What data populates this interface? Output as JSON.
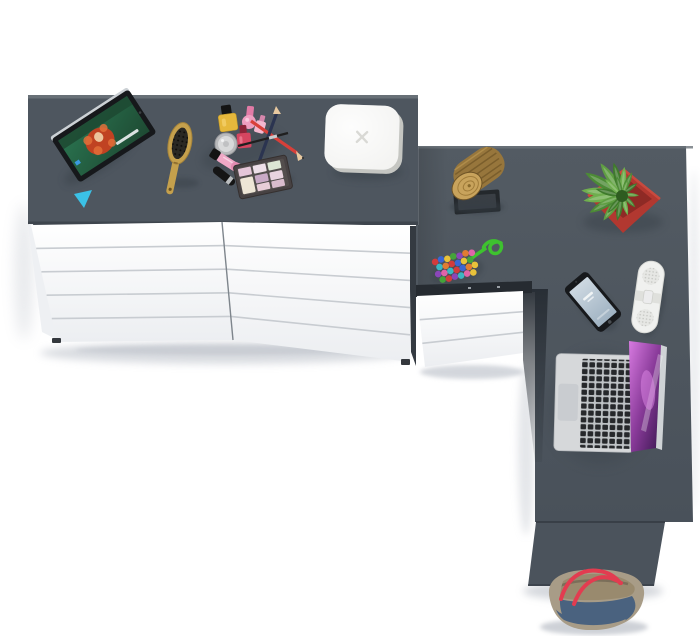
{
  "canvas": {
    "width": 700,
    "height": 636
  },
  "scene": {
    "description": "top-down render of a dresser and corner desk with decor objects",
    "objects": [
      {
        "name": "dresser",
        "top": "slate gray",
        "front": "white",
        "drawer_columns": 2,
        "drawer_rows": 5
      },
      {
        "name": "corner-desk",
        "surface": "slate gray",
        "drawer_unit_drawers": 3,
        "drawer_unit_color": "white"
      },
      {
        "name": "tablet",
        "screen_content": "animated movie still with red-haired character"
      },
      {
        "name": "hairbrush",
        "material": "wood",
        "bristles": "black"
      },
      {
        "name": "makeup-set",
        "items": [
          "yellow nail polish",
          "pink nail polish",
          "red nail polish",
          "cream jar",
          "lip gloss tubes",
          "mascara",
          "red pencil",
          "navy pencil",
          "liner brush",
          "eyeshadow palette"
        ]
      },
      {
        "name": "white-box-speaker",
        "mark": "x logo"
      },
      {
        "name": "wood-stump-decor",
        "on": "black picture frame"
      },
      {
        "name": "potted-plant",
        "pot": "red",
        "leaves": "green rosette"
      },
      {
        "name": "bead-necklace",
        "cord": "green",
        "beads": "multicolor"
      },
      {
        "name": "smartphone",
        "body": "black",
        "screen": "pale blue lock screen"
      },
      {
        "name": "pill-speaker",
        "body": "white"
      },
      {
        "name": "laptop",
        "body": "silver",
        "keys": "black",
        "wallpaper": "purple nebula"
      },
      {
        "name": "tote-bag",
        "body": "denim blue",
        "trim": "taupe",
        "handles": "red"
      }
    ]
  },
  "palette": {
    "slate": "#4e565f",
    "slateBevel": "#6d747b",
    "slateEdge": "#3e454d",
    "deskTop": "#535b63",
    "deskBottom": "#49515a",
    "deskDark": "#2a3036",
    "panel": "#4b535c",
    "drawerWhite": "#ffffff",
    "drawerLine": "#c8ccd1",
    "sideShade": "#eef0f3",
    "foot": "#34383d",
    "shadowFloor": "#c9cdd4",
    "shadowDesk": "#343c45",
    "tabletBlack": "#16181b",
    "screenGreen": "#2a7450",
    "screenGreenDark": "#1e4a33",
    "hairRed": "#c04222",
    "hairOrange": "#e2703a",
    "skin": "#ecc49c",
    "tagCyan": "#3bc1e6",
    "silver": "#ccd1d5",
    "brushWood": "#c5a04c",
    "brushTrim": "#a6843a",
    "bristle": "#2a2823",
    "polishYellow": "#e6b83c",
    "polishPink": "#ee9ec0",
    "polishRed": "#d64560",
    "jar": "#b9babc",
    "gloss": "#f0a8c6",
    "glossDeep": "#e48cb2",
    "capBlack": "#141414",
    "pencilRed": "#d8403a",
    "pencilNavy": "#2b3450",
    "liner": "#1f1f1f",
    "palBody": "#474243",
    "palBed": "#534e4d",
    "cream": "#eee6d6",
    "pan1": "#e5c6d8",
    "pan2": "#eedfe8",
    "pan3": "#dce6d4",
    "pan4": "#c9a9c6",
    "pan5": "#e8d3de",
    "pan6": "#e8cdd8",
    "pan7": "#d9bccd",
    "boxTop": "#f2f2f0",
    "boxSide": "#c5c6c2",
    "boxMark": "#d9d9d5",
    "woodTop": "#c8a35c",
    "woodRing": "#a07c3a",
    "bark": "#97763c",
    "barkDark": "#6f5426",
    "frame": "#24282c",
    "potRed": "#b23830",
    "potLight": "#c84a3e",
    "potDark": "#8e2a25",
    "leafA": "#4c8a36",
    "leafB": "#6fae4e",
    "leafC": "#3f7a2c",
    "leafD": "#5f9e42",
    "leafCore": "#2e5c20",
    "bead1": "#d23b3b",
    "bead2": "#3b66d3",
    "bead3": "#e8c23a",
    "bead4": "#45a33a",
    "bead5": "#8a46b8",
    "bead6": "#e07c32",
    "bead7": "#e064a8",
    "bead8": "#3ab8c2",
    "cord": "#3ec22f",
    "phoneBlack": "#17191c",
    "phoneScr1": "#cdd8e1",
    "phoneScr2": "#9fb2c2",
    "pillWhite": "#f0f1ef",
    "pillBand": "#dfe0dc",
    "pillGrill": "#e6e7e4",
    "pillDot": "#c6c7c3",
    "silverBody": "#d6d8da",
    "key": "#26282b",
    "trackpad": "#c9ccd0",
    "scrPurp1": "#3a1650",
    "scrPurp2": "#8a3b9a",
    "scrPurp3": "#d77ae0",
    "bagTaupe": "#a89c87",
    "bagKhaki": "#998a6e",
    "bagInner": "#6e6250",
    "bagDenim": "#4a627f",
    "bagHandle": "#e23c50"
  }
}
